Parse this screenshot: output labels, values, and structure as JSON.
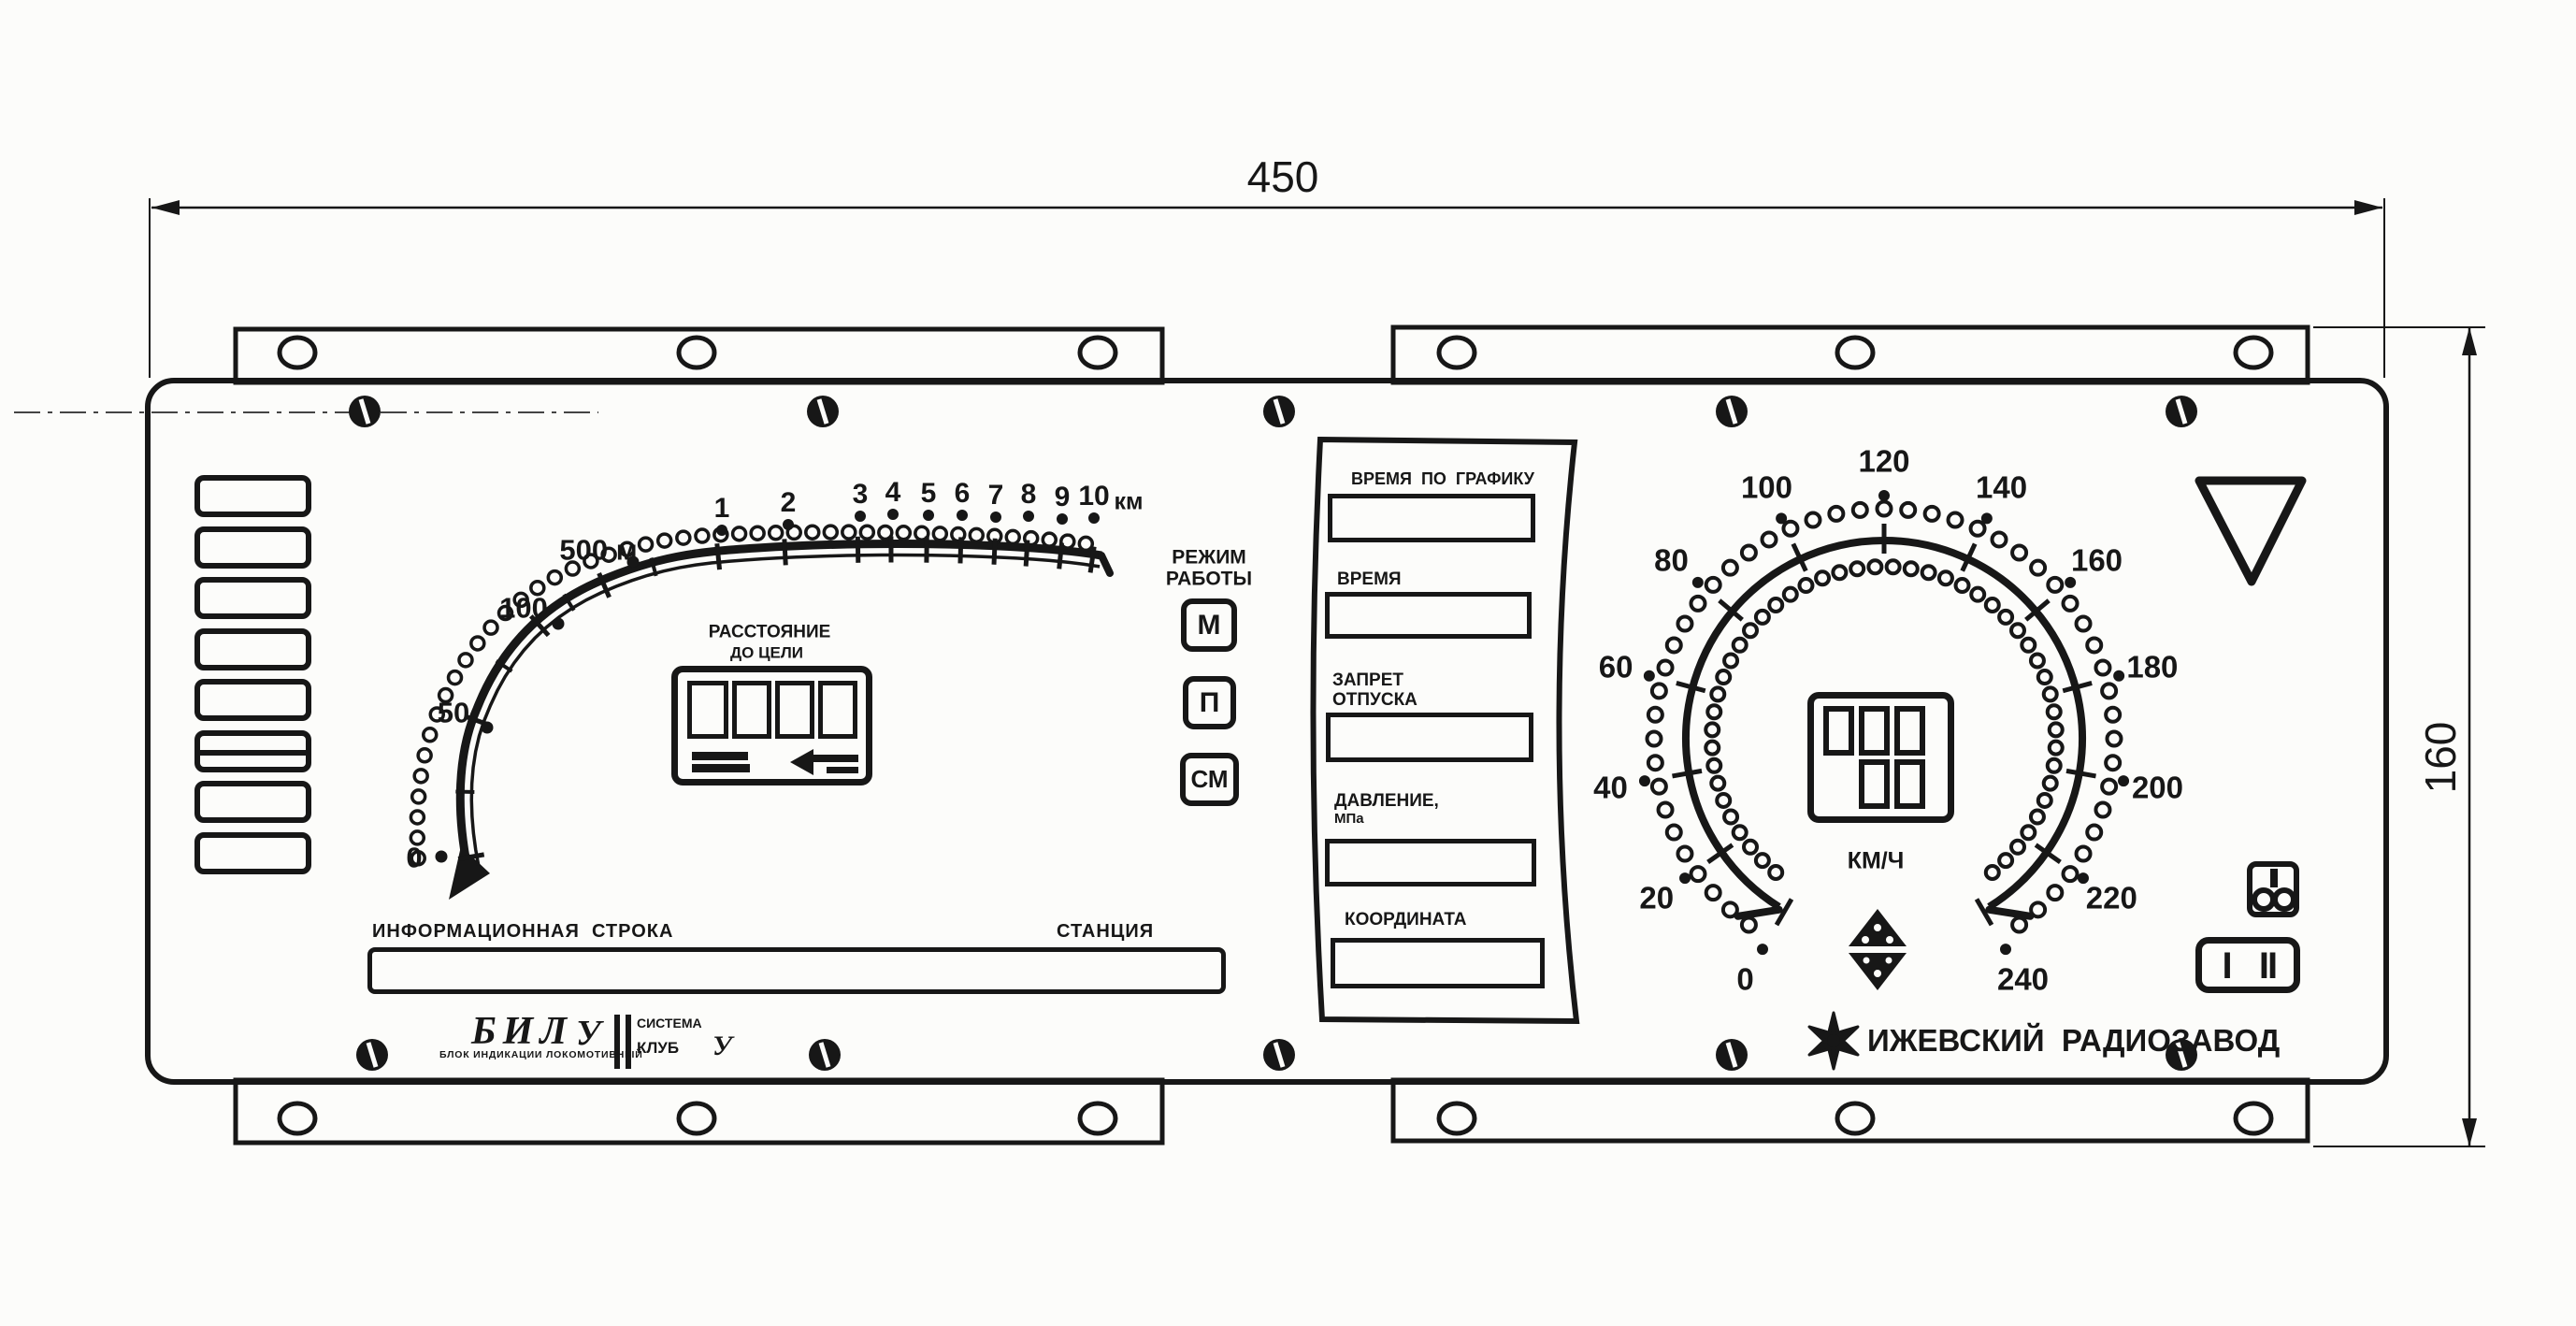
{
  "dimensions": {
    "width": "450",
    "height": "160"
  },
  "distance_gauge": {
    "title": {
      "line1": "РАССТОЯНИЕ",
      "line2": "ДО ЦЕЛИ"
    },
    "meter_labels": [
      "0",
      "50",
      "100",
      "500 м"
    ],
    "km_labels": [
      "1",
      "2",
      "3",
      "4",
      "5",
      "6",
      "7",
      "8",
      "9",
      "10"
    ],
    "km_unit": "км"
  },
  "mode_selector": {
    "title": {
      "line1": "РЕЖИМ",
      "line2": "РАБОТЫ"
    },
    "buttons": [
      "М",
      "П",
      "СМ"
    ]
  },
  "info_panel": {
    "fields": [
      {
        "label1": "ВРЕМЯ  ПО  ГРАФИКУ",
        "label2": ""
      },
      {
        "label1": "ВРЕМЯ",
        "label2": ""
      },
      {
        "label1": "ЗАПРЕТ",
        "label2": "ОТПУСКА"
      },
      {
        "label1": "ДАВЛЕНИЕ,",
        "label2": "МПа"
      },
      {
        "label1": "КООРДИНАТА",
        "label2": ""
      }
    ]
  },
  "speedometer": {
    "labels": [
      "0",
      "20",
      "40",
      "60",
      "80",
      "100",
      "120",
      "140",
      "160",
      "180",
      "200",
      "220",
      "240"
    ],
    "unit": "КМ/Ч"
  },
  "status_line": {
    "info_label": "ИНФОРМАЦИОННАЯ  СТРОКА",
    "station_label": "СТАНЦИЯ"
  },
  "branding": {
    "model": "БИЛ",
    "mod": "У",
    "descriptor": "БЛОК ИНДИКАЦИИ ЛОКОМОТИВНЫЙ",
    "system_word": "СИСТЕМА",
    "system_name": "КЛУБ",
    "system_mod": "У",
    "manufacturer": "ИЖЕВСКИЙ  РАДИОЗАВОД"
  },
  "channel_switch": {
    "labels": [
      "I",
      "II"
    ]
  }
}
